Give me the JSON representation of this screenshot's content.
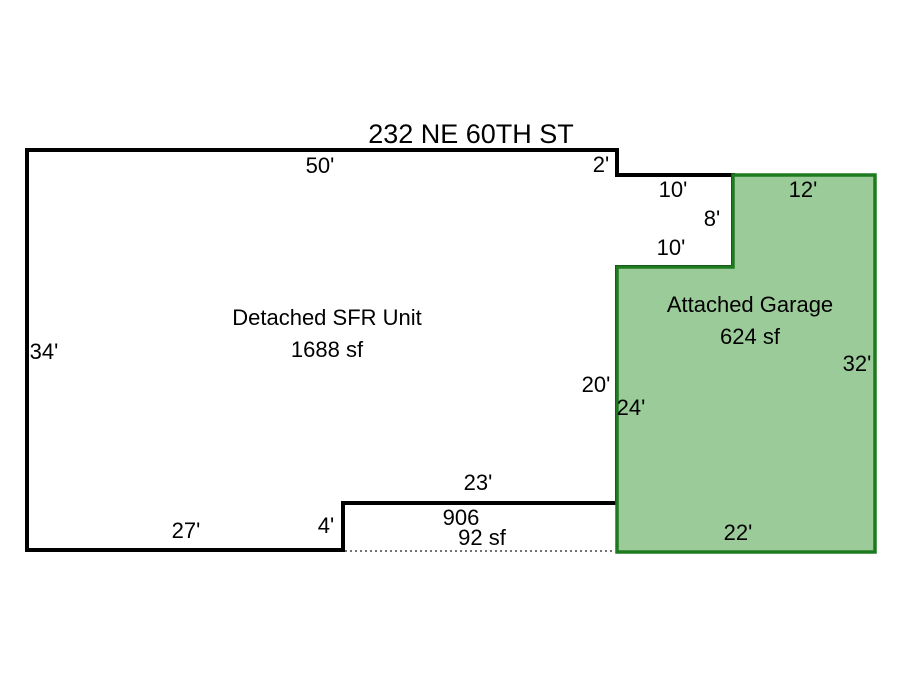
{
  "header": {
    "address": "232 NE 60TH ST"
  },
  "colors": {
    "background": "#ffffff",
    "house_outline": "#000000",
    "house_fill": "#ffffff",
    "garage_fill": "#9ccb9a",
    "garage_outline": "#1e7a1e",
    "garage_text": "#1d8a1d",
    "dim_text": "#000000",
    "porch_dotted": "#444444"
  },
  "house": {
    "label": "Detached SFR Unit",
    "area": "1688 sf",
    "points": "27,150 617,150 617,175 733,175 733,267 617,267 617,503 343,503 343,550 27,550",
    "dims": {
      "top": "50'",
      "step_right": "2'",
      "notch_top": "10'",
      "notch_right": "8'",
      "notch_bottom": "10'",
      "left": "34'",
      "right": "20'",
      "bottom_inner": "23'",
      "step_bottom": "4'",
      "bottom": "27'"
    }
  },
  "garage": {
    "label": "Attached Garage",
    "area": "624 sf",
    "points": "733,175 875,175 875,552 617,552 617,267 733,267",
    "dims": {
      "top": "12'",
      "right": "32'",
      "left": "24'",
      "bottom": "22'"
    }
  },
  "porch": {
    "code": "906",
    "area": "92 sf"
  }
}
